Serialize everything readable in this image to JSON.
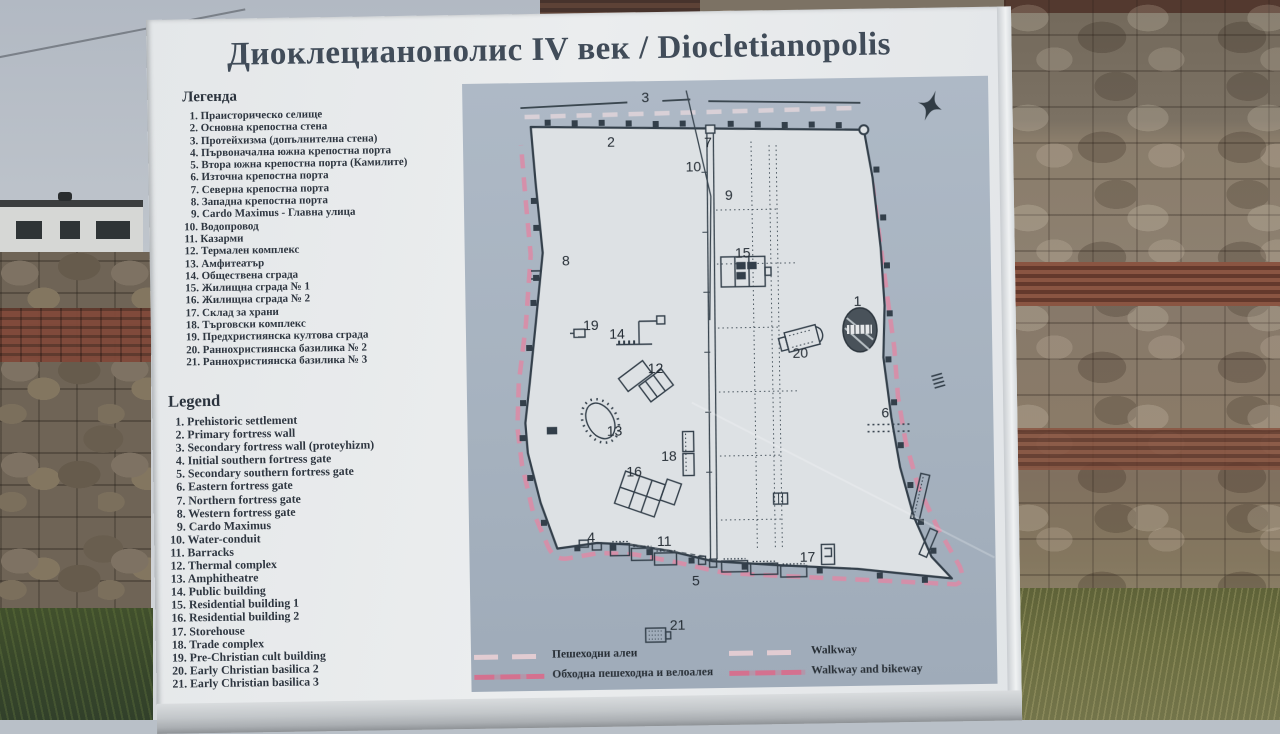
{
  "sign": {
    "title": "Диоклецианополис IV век / Diocletianopolis",
    "legend_bg": {
      "heading": "Легенда",
      "items": [
        "1. Праисторическо селище",
        "2. Основна крепостна стена",
        "3. Протейхизма (допълнителна стена)",
        "4. Първоначална южна крепостна порта",
        "5. Втора южна крепостна порта (Камилите)",
        "6. Източна крепостна порта",
        "7. Северна крепостна порта",
        "8. Западна крепостна порта",
        "9. Cardo Maximus - Главна улица",
        "10. Водопровод",
        "11. Казарми",
        "12. Термален комплекс",
        "13. Амфитеатър",
        "14. Обществена сграда",
        "15. Жилищна сграда № 1",
        "16. Жилищна сграда № 2",
        "17. Склад за храни",
        "18. Търговски комплекс",
        "19. Предхристиянска култова сграда",
        "20. Раннохристиянска базилика № 2",
        "21. Раннохристиянска базилика № 3"
      ]
    },
    "legend_en": {
      "heading": "Legend",
      "items": [
        "1. Prehistoric settlement",
        "2. Primary fortress wall",
        "3. Secondary fortress wall (proteyhizm)",
        "4. Initial southern fortress gate",
        "5. Secondary southern fortress gate",
        "6. Eastern fortress gate",
        "7. Northern fortress gate",
        "8. Western fortress gate",
        "9. Cardo Maximus",
        "10. Water-conduit",
        "11. Barracks",
        "12. Thermal complex",
        "13. Amphitheatre",
        "14. Public building",
        "15. Residential building 1",
        "16. Residential building 2",
        "17. Storehouse",
        "18. Trade complex",
        "19. Pre-Christian cult building",
        "20. Early Christian basilica 2",
        "21. Early Christian basilica 3"
      ]
    },
    "map": {
      "markers": [
        {
          "n": "1",
          "x": 392,
          "y": 223
        },
        {
          "n": "2",
          "x": 148,
          "y": 60
        },
        {
          "n": "3",
          "x": 183,
          "y": 16
        },
        {
          "n": "4",
          "x": 122,
          "y": 455
        },
        {
          "n": "5",
          "x": 226,
          "y": 500
        },
        {
          "n": "6",
          "x": 418,
          "y": 335
        },
        {
          "n": "7",
          "x": 245,
          "y": 62
        },
        {
          "n": "8",
          "x": 101,
          "y": 178
        },
        {
          "n": "9",
          "x": 265,
          "y": 115
        },
        {
          "n": "10",
          "x": 230,
          "y": 86
        },
        {
          "n": "11",
          "x": 195,
          "y": 460
        },
        {
          "n": "12",
          "x": 189,
          "y": 287
        },
        {
          "n": "13",
          "x": 147,
          "y": 349
        },
        {
          "n": "14",
          "x": 151,
          "y": 252
        },
        {
          "n": "15",
          "x": 278,
          "y": 173
        },
        {
          "n": "16",
          "x": 166,
          "y": 390
        },
        {
          "n": "17",
          "x": 338,
          "y": 478
        },
        {
          "n": "18",
          "x": 201,
          "y": 375
        },
        {
          "n": "19",
          "x": 125,
          "y": 243
        },
        {
          "n": "20",
          "x": 334,
          "y": 274
        },
        {
          "n": "21",
          "x": 207,
          "y": 544
        }
      ],
      "legend": {
        "walkway_bg": "Пешеходни алеи",
        "walkway_en": "Walkway",
        "bikeway_bg": "Обходна пешеходна и велоалея",
        "bikeway_en": "Walkway and bikeway"
      },
      "colors": {
        "map_bg": "#a7b3c0",
        "plan_fill": "#dde1e4",
        "wall_line": "#333f4a",
        "bikeway": "#d4718f",
        "walkway": "#e2ccd2"
      }
    }
  }
}
